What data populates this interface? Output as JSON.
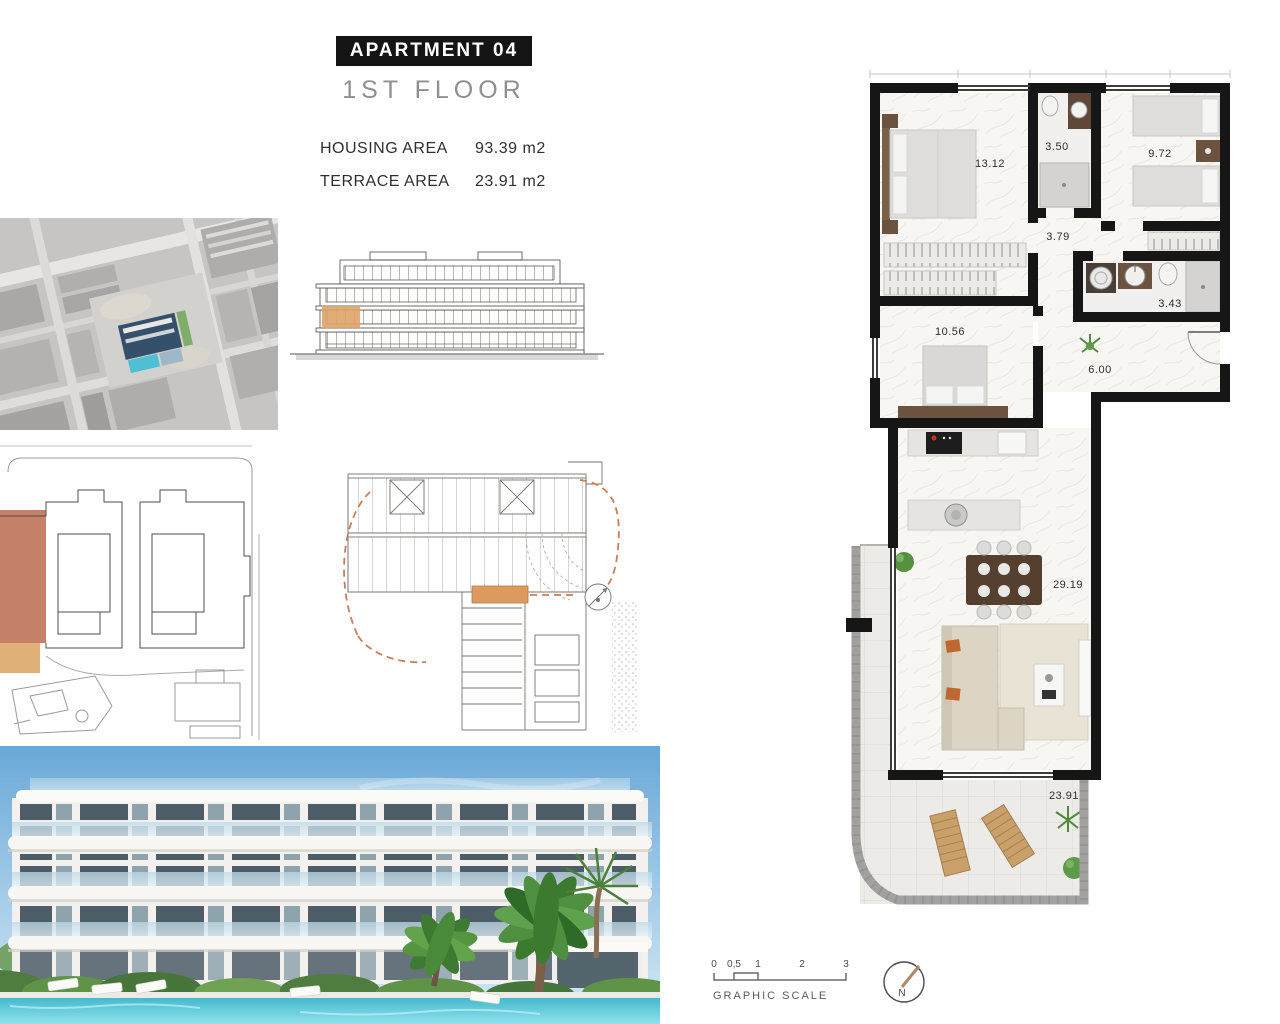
{
  "header": {
    "title": "APARTMENT 04",
    "floor": "1ST FLOOR",
    "housing": {
      "label": "HOUSING AREA",
      "value": "93.39 m2"
    },
    "terrace": {
      "label": "TERRACE AREA",
      "value": "23.91 m2"
    }
  },
  "plan": {
    "rooms": [
      {
        "id": "bedroom-1",
        "area": "13.12"
      },
      {
        "id": "bathroom-1",
        "area": "3.50"
      },
      {
        "id": "bedroom-2",
        "area": "9.72"
      },
      {
        "id": "hallway",
        "area": "3.79"
      },
      {
        "id": "bathroom-2",
        "area": "3.43"
      },
      {
        "id": "bedroom-3",
        "area": "10.56"
      },
      {
        "id": "entrance-hall",
        "area": "6.00"
      },
      {
        "id": "living-dining",
        "area": "29.19"
      },
      {
        "id": "terrace",
        "area": "23.91"
      }
    ]
  },
  "scale_bar": {
    "label": "GRAPHIC SCALE",
    "ticks": [
      "0",
      "0,5",
      "1",
      "2",
      "3"
    ]
  },
  "compass": {
    "north_label": "N"
  },
  "figures": {
    "aerial": "aerial-site-photo",
    "elevation": "building-elevation-drawing",
    "site_plan": "site-plan-drawing",
    "key_plan": "floor-key-plan-drawing",
    "render": "building-exterior-render"
  },
  "colors": {
    "highlight_orange": "#dd9f63",
    "site_highlight_salmon": "#c5806a",
    "site_highlight_tan": "#dfb077",
    "wall_black": "#161616",
    "pool_blue": "#52c2d6",
    "parapet_gray": "#a2a19f"
  }
}
